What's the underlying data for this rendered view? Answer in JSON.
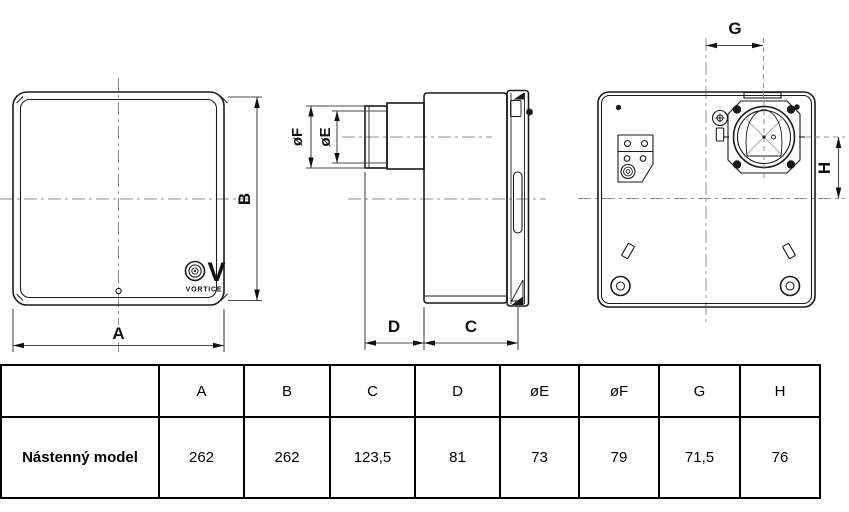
{
  "drawing": {
    "front": {
      "dim_a": "A",
      "dim_b": "B"
    },
    "side": {
      "dim_c": "C",
      "dim_d": "D",
      "dim_oe": "øE",
      "dim_of": "øF"
    },
    "back": {
      "dim_g": "G",
      "dim_h": "H"
    },
    "logo": {
      "v": "V",
      "brand": "VORTICE"
    }
  },
  "table": {
    "headers": [
      "",
      "A",
      "B",
      "C",
      "D",
      "øE",
      "øF",
      "G",
      "H"
    ],
    "rows": [
      {
        "label": "Nástenný model",
        "values": [
          "262",
          "262",
          "123,5",
          "81",
          "73",
          "79",
          "71,5",
          "76"
        ]
      }
    ]
  },
  "colors": {
    "line": "#1a1a1a",
    "centerline": "#8f8f8f",
    "dimension": "#4a4a4a",
    "background": "#ffffff"
  }
}
